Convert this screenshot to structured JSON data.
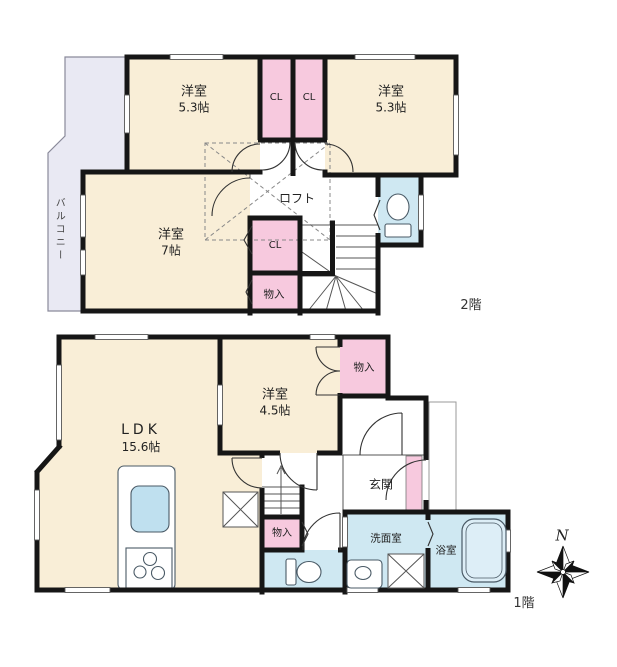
{
  "floor2": {
    "floor_label": "2階",
    "balcony": "バルコニー",
    "bedroom_left_name": "洋室",
    "bedroom_left_size": "5.3帖",
    "bedroom_right_name": "洋室",
    "bedroom_right_size": "5.3帖",
    "closet_left": "CL",
    "closet_right": "CL",
    "closet_mid": "CL",
    "storage": "物入",
    "loft": "ロフト",
    "bedroom_main_name": "洋室",
    "bedroom_main_size": "7帖"
  },
  "floor1": {
    "floor_label": "1階",
    "ldk_name": "LDK",
    "ldk_size": "15.6帖",
    "bedroom_name": "洋室",
    "bedroom_size": "4.5帖",
    "storage_top": "物入",
    "storage_stair": "物入",
    "entrance": "玄関",
    "washroom": "洗面室",
    "bathroom": "浴室"
  },
  "compass": {
    "north": "N"
  },
  "colors": {
    "room_cream": "#f9eed7",
    "closet_pink": "#f7c9de",
    "wet_blue": "#cfe8f2",
    "balcony_gray": "#e9e9f3",
    "wall": "#161616",
    "tub_fill": "#ddeef7",
    "sink_blue": "#bfe0ef"
  }
}
